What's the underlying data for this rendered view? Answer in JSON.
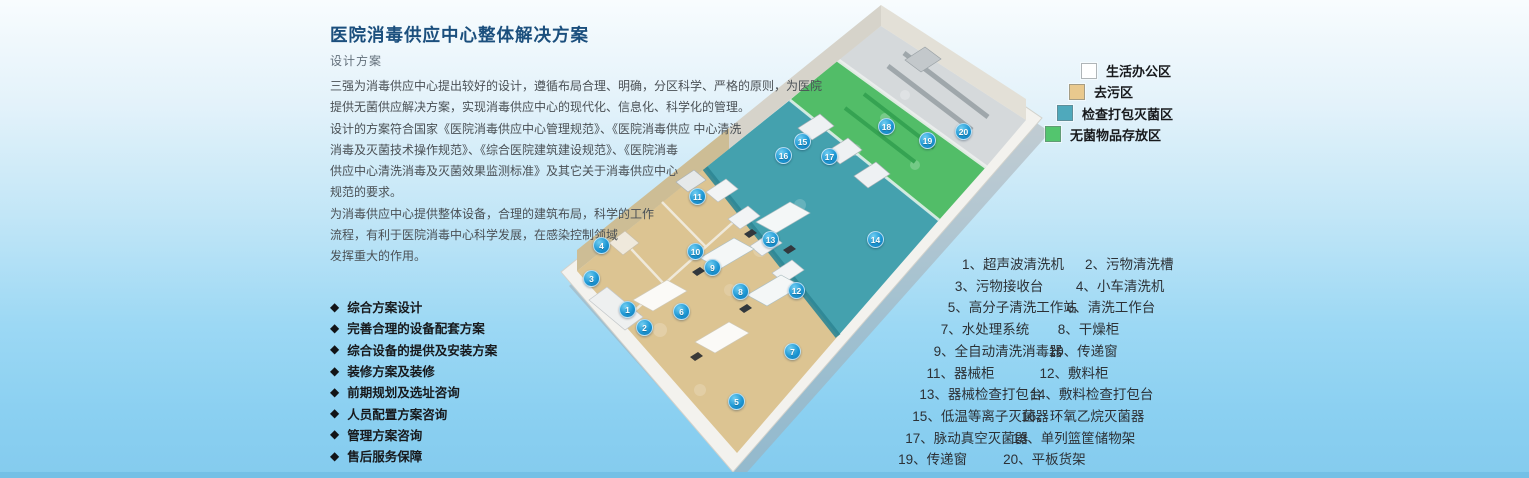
{
  "page": {
    "title": "医院消毒供应中心整体解决方案",
    "subtitle": "设计方案",
    "description": "三强为消毒供应中心提出较好的设计，遵循布局合理、明确，分区科学、严格的原则，为医院\n提供无菌供应解决方案，实现消毒供应中心的现代化、信息化、科学化的管理。\n设计的方案符合国家《医院消毒供应中心管理规范》、《医院消毒供应 中心清洗\n消毒及灭菌技术操作规范》、《综合医院建筑建设规范》、《医院消毒\n供应中心清洗消毒及灭菌效果监测标准》及其它关于消毒供应中心\n规范的要求。\n为消毒供应中心提供整体设备，合理的建筑布局，科学的工作\n流程，有利于医院消毒中心科学发展，在感染控制领域\n发挥重大的作用。"
  },
  "bullets": {
    "icon": "◆",
    "items": [
      "综合方案设计",
      "完善合理的设备配套方案",
      "综合设备的提供及安装方案",
      "装修方案及装修",
      "前期规划及选址咨询",
      "人员配置方案咨询",
      "管理方案咨询",
      "售后服务保障"
    ]
  },
  "legend": {
    "items": [
      {
        "label": "生活办公区",
        "color": "#ffffff"
      },
      {
        "label": "去污区",
        "color": "#e9c98e"
      },
      {
        "label": "检查打包灭菌区",
        "color": "#4fa9bc"
      },
      {
        "label": "无菌物品存放区",
        "color": "#53c56e"
      }
    ]
  },
  "equipment": {
    "rows": [
      [
        "1、超声波清洗机",
        "2、污物清洗槽"
      ],
      [
        "3、污物接收台",
        "4、小车清洗机"
      ],
      [
        "5、高分子清洗工作站",
        "6、清洗工作台"
      ],
      [
        "7、水处理系统",
        "8、干燥柜"
      ],
      [
        "9、全自动清洗消毒器",
        "10、传递窗"
      ],
      [
        "11、器械柜",
        "12、敷料柜"
      ],
      [
        "13、器械检查打包台",
        "14、敷料检查打包台"
      ],
      [
        "15、低温等离子灭菌器",
        "16、环氧乙烷灭菌器"
      ],
      [
        "17、脉动真空灭菌器",
        "18、单列篮筐储物架"
      ],
      [
        "19、传递窗",
        "20、平板货架"
      ]
    ]
  },
  "map": {
    "zone_colors": {
      "office": "#d5d9db",
      "decontamination": "#dcc492",
      "packing": "#44a1ae",
      "sterile": "#52bd68"
    },
    "markers": [
      {
        "n": 1,
        "x": 627,
        "y": 309
      },
      {
        "n": 2,
        "x": 644,
        "y": 327
      },
      {
        "n": 3,
        "x": 591,
        "y": 278
      },
      {
        "n": 4,
        "x": 601,
        "y": 245
      },
      {
        "n": 5,
        "x": 736,
        "y": 401
      },
      {
        "n": 6,
        "x": 681,
        "y": 311
      },
      {
        "n": 7,
        "x": 792,
        "y": 351
      },
      {
        "n": 8,
        "x": 740,
        "y": 291
      },
      {
        "n": 9,
        "x": 712,
        "y": 267
      },
      {
        "n": 10,
        "x": 695,
        "y": 251
      },
      {
        "n": 11,
        "x": 697,
        "y": 196
      },
      {
        "n": 12,
        "x": 796,
        "y": 290
      },
      {
        "n": 13,
        "x": 770,
        "y": 239
      },
      {
        "n": 14,
        "x": 875,
        "y": 239
      },
      {
        "n": 15,
        "x": 802,
        "y": 141
      },
      {
        "n": 16,
        "x": 783,
        "y": 155
      },
      {
        "n": 17,
        "x": 829,
        "y": 156
      },
      {
        "n": 18,
        "x": 886,
        "y": 126
      },
      {
        "n": 19,
        "x": 927,
        "y": 140
      },
      {
        "n": 20,
        "x": 963,
        "y": 131
      }
    ]
  }
}
